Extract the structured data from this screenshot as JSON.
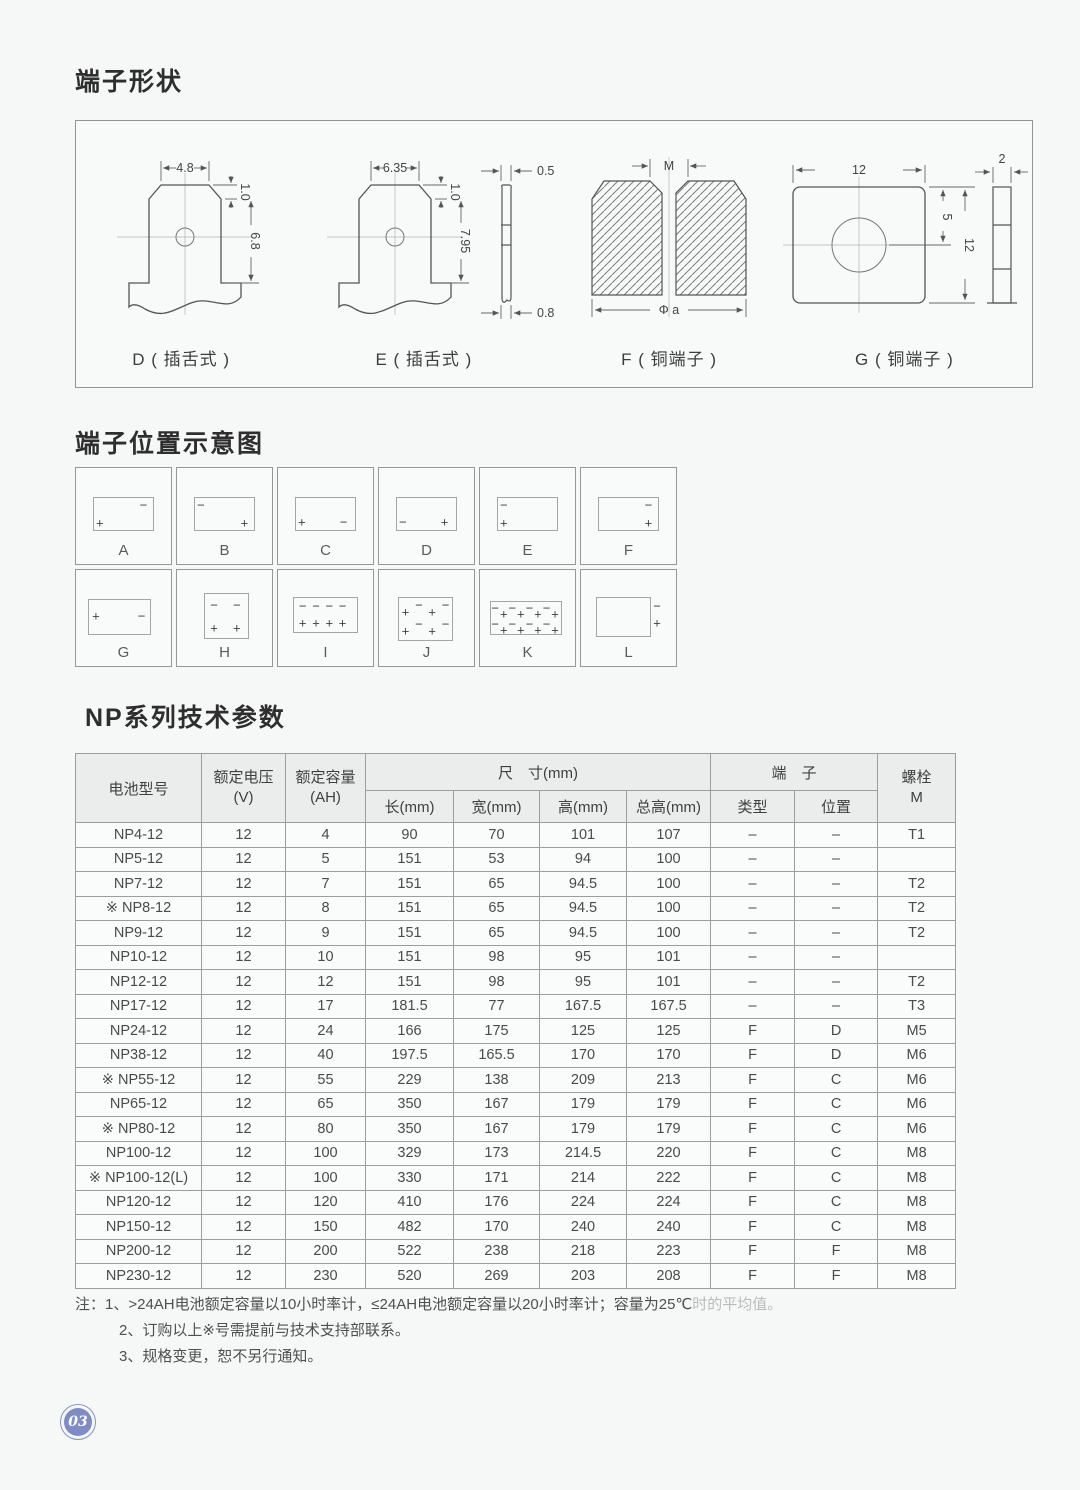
{
  "page": {
    "number": "03"
  },
  "sections": {
    "terminal_shapes": {
      "title": "端子形状",
      "diagrams": {
        "d": {
          "label": "D ( 插舌式 )",
          "dim_width": "4.8",
          "dim_chamfer": "1.0",
          "dim_height": "6.8"
        },
        "e": {
          "label": "E ( 插舌式 )",
          "dim_width": "6.35",
          "dim_chamfer": "1.0",
          "dim_height": "7.95",
          "dim_side_top": "0.5",
          "dim_side_bottom": "0.8"
        },
        "f": {
          "label": "F ( 铜端子 )",
          "dim_slot": "M",
          "dim_diameter": "Φ a"
        },
        "g": {
          "label": "G ( 铜端子 )",
          "dim_width": "12",
          "dim_hole_offset": "5",
          "dim_height": "12",
          "dim_thickness": "2"
        }
      }
    },
    "terminal_positions": {
      "title": "端子位置示意图",
      "cells": [
        {
          "label": "A",
          "box": [
            18,
            30,
            62,
            34
          ],
          "marks": [
            [
              "−",
              71,
              39
            ],
            [
              "+",
              25,
              57
            ]
          ]
        },
        {
          "label": "B",
          "box": [
            18,
            30,
            62,
            34
          ],
          "marks": [
            [
              "−",
              25,
              39
            ],
            [
              "+",
              71,
              57
            ]
          ]
        },
        {
          "label": "C",
          "box": [
            18,
            30,
            62,
            34
          ],
          "marks": [
            [
              "+",
              25,
              56
            ],
            [
              "−",
              69,
              56
            ]
          ]
        },
        {
          "label": "D",
          "box": [
            18,
            30,
            62,
            34
          ],
          "marks": [
            [
              "−",
              25,
              56
            ],
            [
              "+",
              69,
              56
            ]
          ]
        },
        {
          "label": "E",
          "box": [
            18,
            30,
            62,
            34
          ],
          "marks": [
            [
              "−",
              25,
              39
            ],
            [
              "+",
              25,
              57
            ]
          ]
        },
        {
          "label": "F",
          "box": [
            18,
            30,
            62,
            34
          ],
          "marks": [
            [
              "−",
              71,
              39
            ],
            [
              "+",
              71,
              57
            ]
          ]
        },
        {
          "label": "G",
          "box": [
            13,
            30,
            64,
            36
          ],
          "marks": [
            [
              "+",
              21,
              48
            ],
            [
              "−",
              69,
              48
            ]
          ]
        },
        {
          "label": "H",
          "box": [
            28,
            24,
            46,
            46
          ],
          "marks": [
            [
              "−",
              39,
              36
            ],
            [
              "−",
              63,
              36
            ],
            [
              "+",
              39,
              60
            ],
            [
              "+",
              63,
              60
            ]
          ]
        },
        {
          "label": "I",
          "box": [
            16,
            28,
            66,
            36
          ],
          "marks": [
            [
              "−",
              26,
              38
            ],
            [
              "−",
              40,
              38
            ],
            [
              "−",
              54,
              38
            ],
            [
              "−",
              68,
              38
            ],
            [
              "+",
              26,
              55
            ],
            [
              "+",
              40,
              55
            ],
            [
              "+",
              54,
              55
            ],
            [
              "+",
              68,
              55
            ]
          ]
        },
        {
          "label": "J",
          "box": [
            20,
            28,
            56,
            44
          ],
          "marks": [
            [
              "+",
              28,
              44
            ],
            [
              "−",
              42,
              36
            ],
            [
              "+",
              56,
              44
            ],
            [
              "−",
              70,
              36
            ],
            [
              "+",
              28,
              64
            ],
            [
              "−",
              42,
              56
            ],
            [
              "+",
              56,
              64
            ],
            [
              "−",
              70,
              56
            ]
          ]
        },
        {
          "label": "K",
          "box": [
            10,
            32,
            74,
            34
          ],
          "marks": [
            [
              "−",
              16,
              40
            ],
            [
              "+",
              25,
              46
            ],
            [
              "−",
              34,
              40
            ],
            [
              "+",
              43,
              46
            ],
            [
              "−",
              52,
              40
            ],
            [
              "+",
              61,
              46
            ],
            [
              "−",
              70,
              40
            ],
            [
              "+",
              79,
              46
            ],
            [
              "−",
              16,
              56
            ],
            [
              "+",
              25,
              62
            ],
            [
              "−",
              34,
              56
            ],
            [
              "+",
              43,
              62
            ],
            [
              "−",
              52,
              56
            ],
            [
              "+",
              61,
              62
            ],
            [
              "−",
              70,
              56
            ],
            [
              "+",
              79,
              62
            ]
          ]
        },
        {
          "label": "L",
          "box": [
            16,
            28,
            56,
            40
          ],
          "marks": [
            [
              "−",
              80,
              38
            ],
            [
              "+",
              80,
              55
            ]
          ]
        }
      ]
    },
    "table_section": {
      "title": "NP系列技术参数",
      "header": {
        "model": "电池型号",
        "voltage": "额定电压",
        "voltage_unit": "(V)",
        "capacity": "额定容量",
        "capacity_unit": "(AH)",
        "dimensions": "尺　寸(mm)",
        "terminal": "端　子",
        "bolt": "螺栓",
        "bolt_unit": "M",
        "sub": [
          "长(mm)",
          "宽(mm)",
          "高(mm)",
          "总高(mm)",
          "类型",
          "位置"
        ]
      },
      "rows": [
        [
          "NP4-12",
          "12",
          "4",
          "90",
          "70",
          "101",
          "107",
          "–",
          "–",
          "T1"
        ],
        [
          "NP5-12",
          "12",
          "5",
          "151",
          "53",
          "94",
          "100",
          "–",
          "–",
          ""
        ],
        [
          "NP7-12",
          "12",
          "7",
          "151",
          "65",
          "94.5",
          "100",
          "–",
          "–",
          "T2"
        ],
        [
          "※ NP8-12",
          "12",
          "8",
          "151",
          "65",
          "94.5",
          "100",
          "–",
          "–",
          "T2"
        ],
        [
          "NP9-12",
          "12",
          "9",
          "151",
          "65",
          "94.5",
          "100",
          "–",
          "–",
          "T2"
        ],
        [
          "NP10-12",
          "12",
          "10",
          "151",
          "98",
          "95",
          "101",
          "–",
          "–",
          ""
        ],
        [
          "NP12-12",
          "12",
          "12",
          "151",
          "98",
          "95",
          "101",
          "–",
          "–",
          "T2"
        ],
        [
          "NP17-12",
          "12",
          "17",
          "181.5",
          "77",
          "167.5",
          "167.5",
          "–",
          "–",
          "T3"
        ],
        [
          "NP24-12",
          "12",
          "24",
          "166",
          "175",
          "125",
          "125",
          "F",
          "D",
          "M5"
        ],
        [
          "NP38-12",
          "12",
          "40",
          "197.5",
          "165.5",
          "170",
          "170",
          "F",
          "D",
          "M6"
        ],
        [
          "※ NP55-12",
          "12",
          "55",
          "229",
          "138",
          "209",
          "213",
          "F",
          "C",
          "M6"
        ],
        [
          "NP65-12",
          "12",
          "65",
          "350",
          "167",
          "179",
          "179",
          "F",
          "C",
          "M6"
        ],
        [
          "※ NP80-12",
          "12",
          "80",
          "350",
          "167",
          "179",
          "179",
          "F",
          "C",
          "M6"
        ],
        [
          "NP100-12",
          "12",
          "100",
          "329",
          "173",
          "214.5",
          "220",
          "F",
          "C",
          "M8"
        ],
        [
          "※ NP100-12(L)",
          "12",
          "100",
          "330",
          "171",
          "214",
          "222",
          "F",
          "C",
          "M8"
        ],
        [
          "NP120-12",
          "12",
          "120",
          "410",
          "176",
          "224",
          "224",
          "F",
          "C",
          "M8"
        ],
        [
          "NP150-12",
          "12",
          "150",
          "482",
          "170",
          "240",
          "240",
          "F",
          "C",
          "M8"
        ],
        [
          "NP200-12",
          "12",
          "200",
          "522",
          "238",
          "218",
          "223",
          "F",
          "F",
          "M8"
        ],
        [
          "NP230-12",
          "12",
          "230",
          "520",
          "269",
          "203",
          "208",
          "F",
          "F",
          "M8"
        ]
      ]
    },
    "notes": {
      "line1": "注：1、>24AH电池额定容量以10小时率计，≤24AH电池额定容量以20小时率计；容量为25℃",
      "line1_faded": "时的平均值。",
      "line2": "2、订购以上※号需提前与技术支持部联系。",
      "line3": "3、规格变更，恕不另行通知。"
    }
  }
}
